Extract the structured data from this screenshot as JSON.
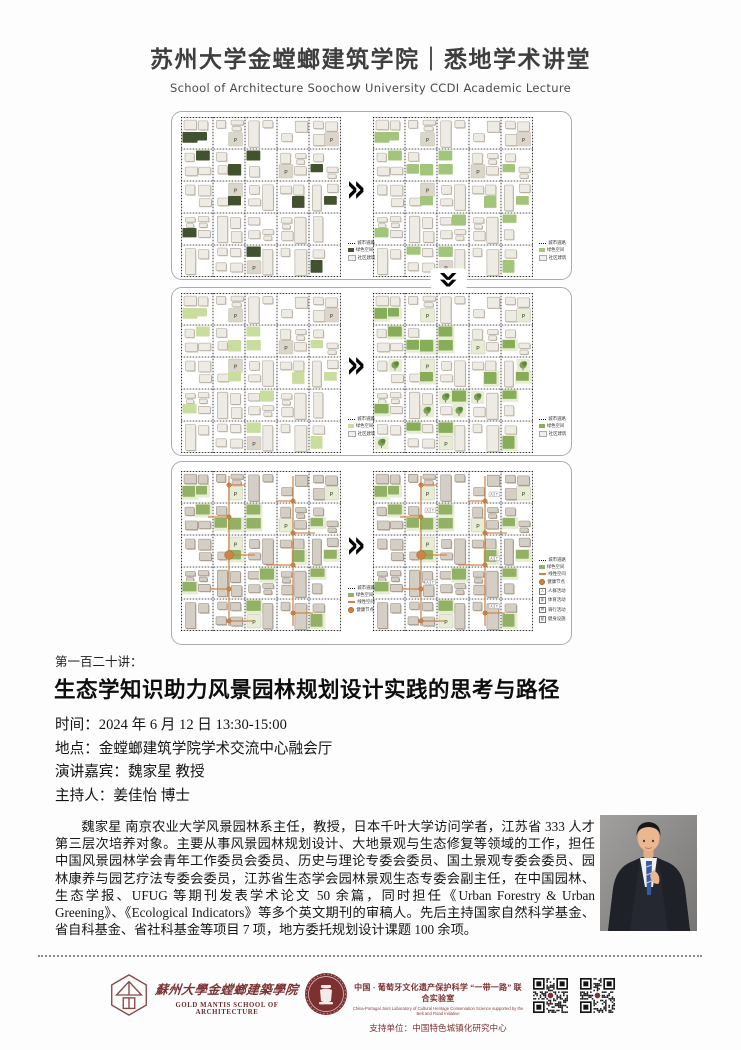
{
  "header": {
    "title": "苏州大学金螳螂建筑学院｜悉地学术讲堂",
    "subtitle": "School of Architecture Soochow University CCDI Academic Lecture"
  },
  "diagram": {
    "arrow": "»",
    "legend_labels": {
      "road": "城市道路",
      "green": "绿色空间",
      "building": "社区建筑",
      "linear": "线性空间",
      "node": "健康节点",
      "people": "人群活动",
      "sport": "体育活动",
      "ride": "骑行活动",
      "fitness": "健身设施"
    },
    "colors": {
      "bldg": "#edebe4",
      "bldgStroke": "#a8a195",
      "bldgShadow": "#ccc6bb",
      "warmBldg": "#d5cec4",
      "warmStroke": "#958c80",
      "warmShadow": "#b6ada1",
      "orange": "#cf8342",
      "orangeDark": "#a96828",
      "pale": "#e7ecd4",
      "plaza": "#dbd5ca",
      "road": "#1a1a1a",
      "treeCanopy": "#7da35a",
      "treeCanopy2": "#5e8a3e",
      "trunk": "#7a5b3a"
    },
    "panels": [
      {
        "maps": [
          {
            "green": "#42522e",
            "greens": 12
          },
          {
            "green": "#a3c57b",
            "greens": 17
          }
        ],
        "legends": [
          [
            "road",
            "green",
            "building"
          ],
          [
            "road",
            "green",
            "building"
          ]
        ]
      },
      {
        "maps": [
          {
            "green": "#c8dd9e",
            "greens": 14
          },
          {
            "green": "#88ad58",
            "greens": 17,
            "trees": true,
            "paleP": true
          }
        ],
        "legends": [
          [
            "road",
            "green",
            "building"
          ],
          [
            "road",
            "green",
            "building"
          ]
        ]
      },
      {
        "warm": true,
        "maps": [
          {
            "green": "#93b164",
            "greens": 16,
            "paleP": true,
            "network": true
          },
          {
            "green": "#93b164",
            "greens": 16,
            "paleP": true,
            "network": true,
            "icons": true
          }
        ],
        "legends": [
          [
            "road",
            "green",
            "linear",
            "node"
          ],
          [
            "road",
            "green",
            "linear",
            "node",
            "people",
            "sport",
            "ride",
            "fitness"
          ]
        ]
      }
    ],
    "icon_glyphs": {
      "people": "人",
      "sport": "体",
      "ride": "骑",
      "fitness": "健"
    },
    "parking_label": "P"
  },
  "lecture": {
    "series_no": "第一百二十讲：",
    "title": "生态学知识助力风景园林规划设计实践的思考与路径",
    "time": "时间：2024 年 6 月 12 日 13:30-15:00",
    "place": "地点：金螳螂建筑学院学术交流中心融会厅",
    "speaker": "演讲嘉宾：魏家星 教授",
    "host": "主持人：姜佳怡 博士"
  },
  "bio": {
    "text": "魏家星 南京农业大学风景园林系主任，教授，日本千叶大学访问学者，江苏省 333 人才第三层次培养对象。主要从事风景园林规划设计、大地景观与生态修复等领域的工作，担任中国风景园林学会青年工作委员会委员、历史与理论专委会委员、国土景观专委会委员、园林康养与园艺疗法专委会委员，江苏省生态学会园林景观生态专委会副主任，在中国园林、生态学报、UFUG 等期刊发表学术论文 50 余篇，同时担任《Urban Forestry & Urban Greening》、《Ecological Indicators》等多个英文期刊的审稿人。先后主持国家自然科学基金、省自科基金、省社科基金等项目 7 项，地方委托规划设计课题 100 余项。"
  },
  "footer": {
    "school_cn": "蘇州大學金螳螂建築學院",
    "school_en": "GOLD MANTIS SCHOOL OF ARCHITECTURE",
    "lab_cn": "中国 - 葡萄牙文化遗产保护科学 “一带一路” 联合实验室",
    "lab_en": "China-Portugal Joint Laboratory of Cultural Heritage Conservation Science supported by the Belt and Road Initiative",
    "support": "支持单位：中国特色城镇化研究中心",
    "maroon": "#7c3333"
  }
}
